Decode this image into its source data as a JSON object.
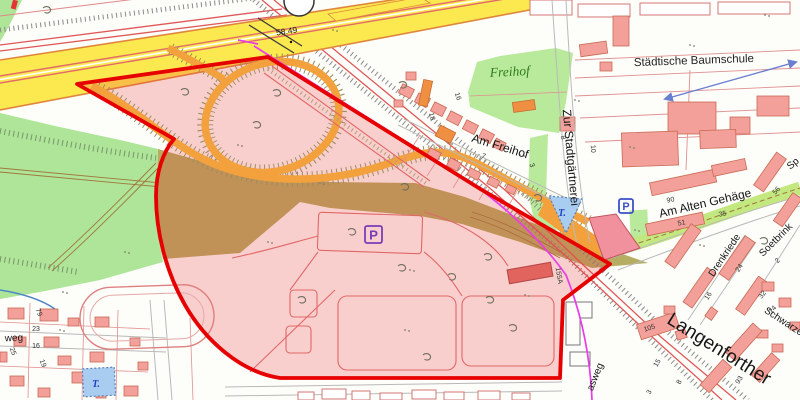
{
  "map": {
    "colors": {
      "highlight_fill": "rgba(236,58,58,0.23)",
      "highlight_border": "#e60000",
      "highway_yellow": "#fce94f",
      "ramp_orange": "#f2a13c",
      "green_area": "#aee598",
      "olive_area": "#b4ad62",
      "building_salmon": "#f2a099",
      "building_orange": "#ef8f41",
      "pond_blue": "#a9cdf0",
      "pipeline_magenta": "#e93ce9",
      "survey_arrow_blue": "#6a7fd0"
    },
    "labels": [
      {
        "text": "58.49",
        "x": 287,
        "y": 34,
        "rot": -8,
        "cls": "elev"
      },
      {
        "text": "Freihof",
        "x": 510,
        "y": 76,
        "rot": -3,
        "cls": "green-place"
      },
      {
        "text": "Städtische Baumschule",
        "x": 694,
        "y": 64,
        "rot": -2,
        "cls": "place"
      },
      {
        "text": "Zur Stadtgärtnerei",
        "x": 567,
        "y": 158,
        "rot": 85,
        "cls": "street-lg"
      },
      {
        "text": "Am Freihof",
        "x": 499,
        "y": 150,
        "rot": 17,
        "cls": "street-lg"
      },
      {
        "text": "Am Alten Gehäge",
        "x": 706,
        "y": 207,
        "rot": -13,
        "cls": "street-lg"
      },
      {
        "text": "Drenkriede",
        "x": 727,
        "y": 257,
        "rot": -56,
        "cls": "street-md"
      },
      {
        "text": "Soetbrink",
        "x": 778,
        "y": 242,
        "rot": -45,
        "cls": "street-md"
      },
      {
        "text": "Schwarze",
        "x": 782,
        "y": 324,
        "rot": 33,
        "cls": "street-md"
      },
      {
        "text": "Langenforther",
        "x": 716,
        "y": 354,
        "rot": 32,
        "cls": "street-xl"
      },
      {
        "text": "asweg",
        "x": 598,
        "y": 378,
        "rot": -68,
        "cls": "street-md"
      },
      {
        "text": "weg",
        "x": 14,
        "y": 341,
        "rot": -2,
        "cls": "street-md"
      },
      {
        "text": "Sp",
        "x": 795,
        "y": 166,
        "rot": -40,
        "cls": "street-md"
      }
    ],
    "house_numbers": [
      {
        "text": "18",
        "x": 430,
        "y": 117,
        "rot": 75
      },
      {
        "text": "16",
        "x": 456,
        "y": 97,
        "rot": 72
      },
      {
        "text": "7",
        "x": 483,
        "y": 158,
        "rot": 20
      },
      {
        "text": "3",
        "x": 530,
        "y": 166,
        "rot": 70
      },
      {
        "text": "8",
        "x": 561,
        "y": 138,
        "rot": 78
      },
      {
        "text": "10",
        "x": 591,
        "y": 149,
        "rot": 86
      },
      {
        "text": "155A",
        "x": 557,
        "y": 276,
        "rot": 80
      },
      {
        "text": "90",
        "x": 671,
        "y": 202,
        "rot": -12
      },
      {
        "text": "51",
        "x": 682,
        "y": 225,
        "rot": -12
      },
      {
        "text": "35",
        "x": 723,
        "y": 216,
        "rot": -12
      },
      {
        "text": "56",
        "x": 778,
        "y": 192,
        "rot": -48
      },
      {
        "text": "2",
        "x": 779,
        "y": 262,
        "rot": -48
      },
      {
        "text": "32",
        "x": 764,
        "y": 296,
        "rot": -52
      },
      {
        "text": "24",
        "x": 741,
        "y": 269,
        "rot": -58
      },
      {
        "text": "16",
        "x": 710,
        "y": 297,
        "rot": -58
      },
      {
        "text": "14",
        "x": 774,
        "y": 311,
        "rot": -45
      },
      {
        "text": "105",
        "x": 650,
        "y": 330,
        "rot": -18
      },
      {
        "text": "15",
        "x": 659,
        "y": 364,
        "rot": -60
      },
      {
        "text": "8",
        "x": 681,
        "y": 383,
        "rot": -60
      },
      {
        "text": "3",
        "x": 651,
        "y": 393,
        "rot": -60
      },
      {
        "text": "93",
        "x": 741,
        "y": 381,
        "rot": -58
      },
      {
        "text": "79",
        "x": 37,
        "y": 313,
        "rot": 70
      },
      {
        "text": "23",
        "x": 36,
        "y": 331,
        "rot": 0
      },
      {
        "text": "16",
        "x": 36,
        "y": 348,
        "rot": 0
      },
      {
        "text": "19",
        "x": 41,
        "y": 364,
        "rot": 70
      },
      {
        "text": "25",
        "x": 11,
        "y": 352,
        "rot": 70
      }
    ],
    "symbols": {
      "parking_signs": [
        {
          "label": "P",
          "x": 365,
          "y": 226,
          "s": 17,
          "color": "#7a3db8"
        },
        {
          "label": "P",
          "x": 619,
          "y": 199,
          "s": 14,
          "color": "#3c50c8"
        }
      ],
      "pond_labels": [
        {
          "text": "T.",
          "x": 562,
          "y": 216
        },
        {
          "text": "T.",
          "x": 96,
          "y": 387
        }
      ],
      "elevation_dot": {
        "x": 291,
        "y": 42
      },
      "survey_arrow": {
        "x1": 665,
        "y1": 99,
        "x2": 796,
        "y2": 62
      }
    },
    "trees": [
      [
        47,
        10
      ],
      [
        185,
        92
      ],
      [
        277,
        93
      ],
      [
        257,
        125
      ],
      [
        403,
        85
      ],
      [
        405,
        187
      ],
      [
        302,
        300
      ],
      [
        402,
        268
      ],
      [
        452,
        277
      ],
      [
        490,
        300
      ],
      [
        513,
        328
      ],
      [
        427,
        357
      ],
      [
        488,
        257
      ],
      [
        538,
        198
      ],
      [
        764,
        241
      ],
      [
        352,
        232
      ]
    ],
    "grass_dots": [
      [
        333,
        30
      ],
      [
        238,
        145
      ],
      [
        125,
        252
      ],
      [
        63,
        292
      ],
      [
        410,
        270
      ],
      [
        520,
        155
      ],
      [
        630,
        147
      ],
      [
        575,
        100
      ],
      [
        690,
        45
      ],
      [
        765,
        15
      ],
      [
        700,
        245
      ],
      [
        405,
        330
      ],
      [
        525,
        295
      ],
      [
        320,
        183
      ],
      [
        635,
        230
      ],
      [
        448,
        143
      ],
      [
        268,
        242
      ],
      [
        60,
        330
      ]
    ]
  }
}
